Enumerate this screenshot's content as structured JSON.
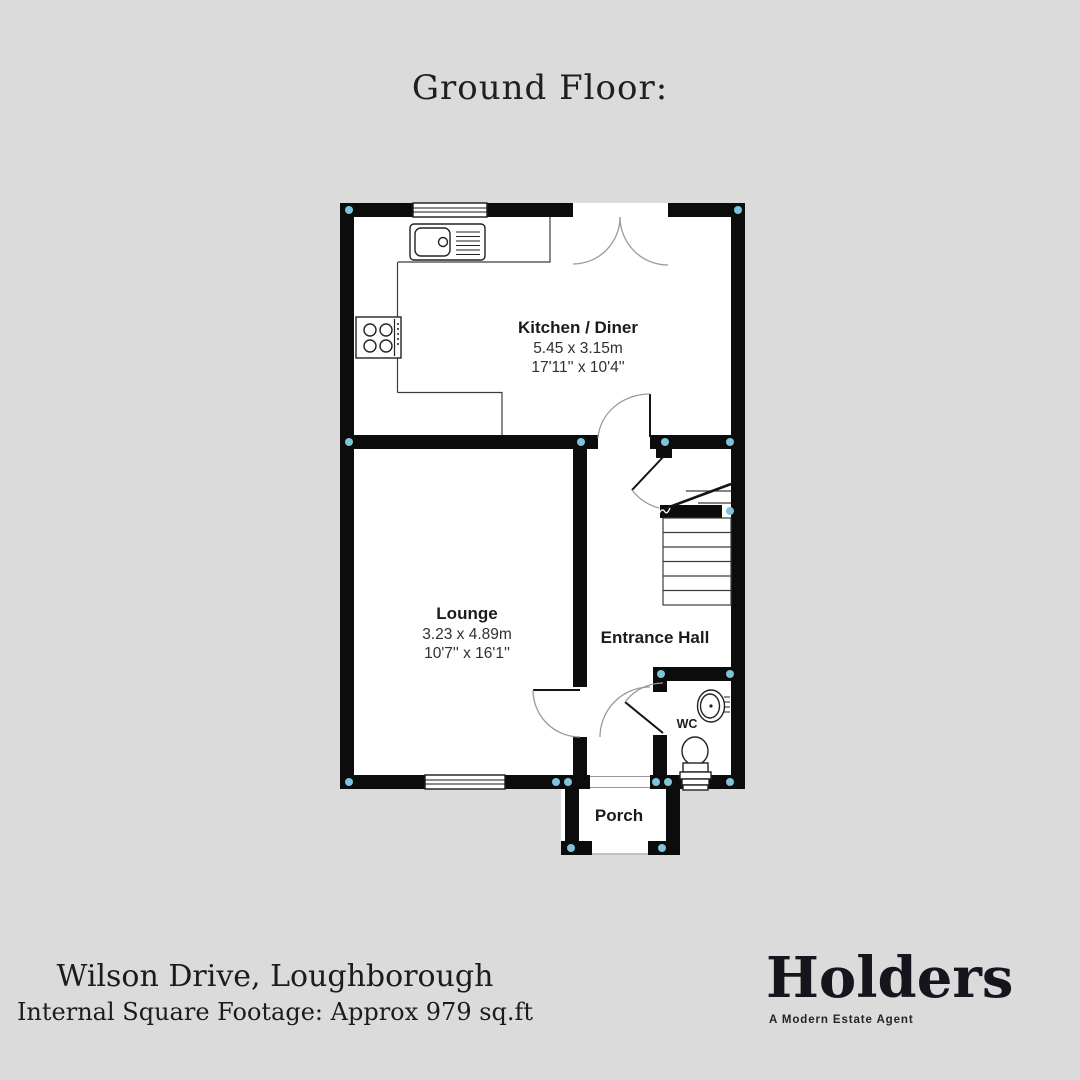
{
  "page": {
    "background": "#dbdbdb",
    "title": "Ground Floor:"
  },
  "floorplan": {
    "colors": {
      "wall": "#0c0c0c",
      "room": "#ffffff",
      "corner_marker": "#7ec4dd",
      "door_arc": "#9a9a9a",
      "label": "#1b1b1b"
    },
    "rooms": [
      {
        "id": "kitchen",
        "name": "Kitchen / Diner",
        "size_metric": "5.45 x 3.15m",
        "size_imperial": "17'11'' x 10'4''"
      },
      {
        "id": "lounge",
        "name": "Lounge",
        "size_metric": "3.23 x 4.89m",
        "size_imperial": "10'7'' x 16'1''"
      },
      {
        "id": "entrance-hall",
        "name": "Entrance Hall"
      },
      {
        "id": "wc",
        "name": "WC"
      },
      {
        "id": "porch",
        "name": "Porch"
      }
    ]
  },
  "footer": {
    "address": "Wilson Drive, Loughborough",
    "square_footage": "Internal Square Footage: Approx 979 sq.ft"
  },
  "brand": {
    "name": "Holders",
    "tagline": "A Modern Estate Agent"
  }
}
